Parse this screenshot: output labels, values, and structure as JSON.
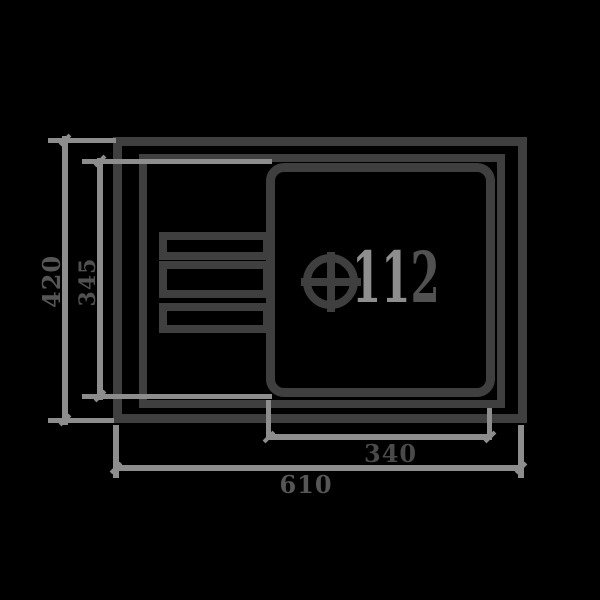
{
  "figure": {
    "kind": "sink_top_view_technical_drawing",
    "colors": {
      "background": "#000000",
      "outline": "#3f3f3f",
      "dimension_line": "#8d8d8d",
      "dimension_text": "#565656",
      "drain_label_light": "#8e8e8e",
      "drain_label_dark": "#515151"
    },
    "drain": {
      "label_left": "11",
      "label_right": "2"
    },
    "dimensions": {
      "overall_width": "610",
      "bowl_width": "340",
      "overall_depth": "420",
      "bowl_depth": "345"
    }
  }
}
